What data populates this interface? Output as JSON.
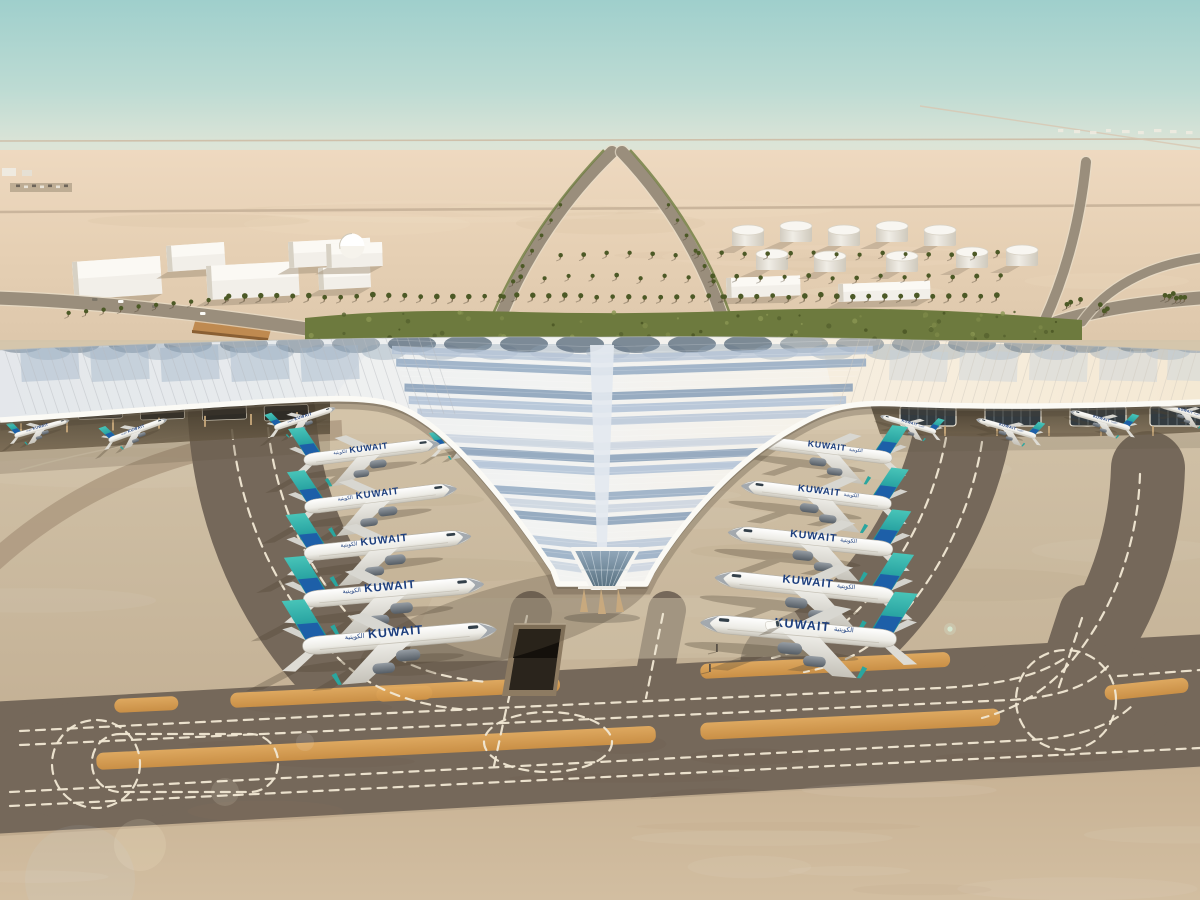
{
  "image": {
    "width": 1200,
    "height": 900,
    "type": "architectural_rendering",
    "subject": "Aerial rendering of a Y-shaped airport terminal in the desert"
  },
  "scene": {
    "description": "Aerial architectural rendering of Kuwait International Airport Terminal 2: a white trefoil ribbed canopy with blue photovoltaic panels, Kuwait Airways aircraft with teal tails parked at angled piers, desert horizon with support buildings and fuel tanks, landscaped green strip, and dark taxiways with white dashed guidance lines and orange shoulder strips.",
    "airline": {
      "title": "KUWAIT",
      "arabic": "الكويتية"
    },
    "counts": {
      "aircraft_total": 19,
      "aircraft_left_pier": 5,
      "aircraft_right_pier": 5,
      "aircraft_left_wing": 5,
      "aircraft_right_wing": 4,
      "fuel_tanks": 10
    },
    "aircraft": [
      {
        "x": 18,
        "y": 396,
        "s": 0.48,
        "r": -14,
        "d": 1
      },
      {
        "x": 42,
        "y": 428,
        "s": 0.55,
        "r": -16,
        "d": 1
      },
      {
        "x": 138,
        "y": 430,
        "s": 0.6,
        "r": -20,
        "d": 1
      },
      {
        "x": 305,
        "y": 418,
        "s": 0.62,
        "r": -18,
        "d": 1
      },
      {
        "x": 470,
        "y": 442,
        "s": 0.64,
        "r": -10,
        "d": 1
      },
      {
        "x": 908,
        "y": 424,
        "s": 0.56,
        "r": 16,
        "d": -1
      },
      {
        "x": 1006,
        "y": 428,
        "s": 0.6,
        "r": 16,
        "d": -1
      },
      {
        "x": 1100,
        "y": 420,
        "s": 0.6,
        "r": 16,
        "d": -1
      },
      {
        "x": 1184,
        "y": 412,
        "s": 0.54,
        "r": 16,
        "d": -1
      },
      {
        "x": 372,
        "y": 452,
        "s": 1.32,
        "r": -7,
        "d": 1
      },
      {
        "x": 381,
        "y": 498,
        "s": 1.48,
        "r": -7,
        "d": 1
      },
      {
        "x": 388,
        "y": 545,
        "s": 1.62,
        "r": -6,
        "d": 1
      },
      {
        "x": 394,
        "y": 592,
        "s": 1.75,
        "r": -5,
        "d": 1
      },
      {
        "x": 400,
        "y": 638,
        "s": 1.88,
        "r": -5,
        "d": 1
      },
      {
        "x": 824,
        "y": 450,
        "s": 1.32,
        "r": 7,
        "d": -1
      },
      {
        "x": 816,
        "y": 495,
        "s": 1.46,
        "r": 7,
        "d": -1
      },
      {
        "x": 810,
        "y": 541,
        "s": 1.6,
        "r": 6,
        "d": -1
      },
      {
        "x": 804,
        "y": 587,
        "s": 1.74,
        "r": 6,
        "d": -1
      },
      {
        "x": 798,
        "y": 631,
        "s": 1.9,
        "r": 5,
        "d": -1
      }
    ],
    "palette": {
      "sky_teal": "#9fcfcc",
      "haze": "#e7ddc9",
      "desert": "#e6d1b6",
      "apron": "#cbbaa0",
      "taxiway_dark": "#75685a",
      "shoulder_orange": "#dca45a",
      "marking": "#f1e8d4",
      "roof_white": "#f2f3f2",
      "roof_panel_blue": "#93aac4",
      "greenery": "#6d7a3e",
      "tail_teal": "#2fb0a8",
      "tail_blue": "#1d5ca9",
      "fuselage_white": "#ffffff",
      "building_white": "#f2efe9"
    }
  }
}
